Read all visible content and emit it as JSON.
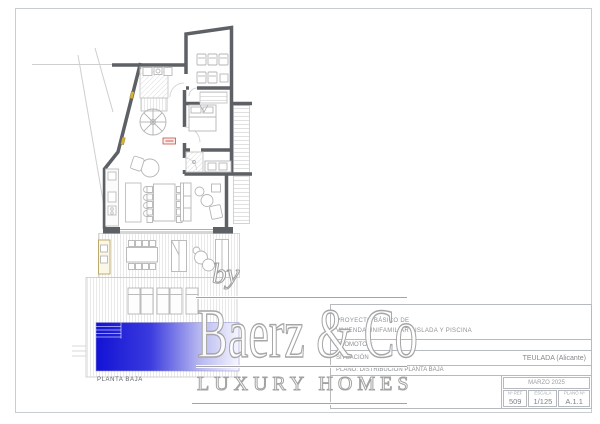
{
  "plan": {
    "floor_label": "PLANTA BAJA"
  },
  "watermark": {
    "by": "by",
    "brand": "Baerz & Co",
    "tagline": "LUXURY HOMES"
  },
  "title_block": {
    "project_line1": "PROYECTO BÁSICO DE",
    "project_line2": "VIVIENDA UNIFAMILIAR AISLADA Y PISCINA",
    "promoter_label": "PROMOTOR:",
    "location_label": "SITUACIÓN",
    "location_value": "TEULADA (Alicante)",
    "sheet_title": "PLANO: DISTRIBUCIÓN PLANTA BAJA",
    "date": "MARZO 2025",
    "ref_label": "Nº REF",
    "ref_value": "509",
    "scale_label": "ESCALA",
    "scale_value": "1/125",
    "sheet_no_label": "PLANO Nº",
    "sheet_no_value": "A.1.1"
  },
  "colors": {
    "wall": "#5d6064",
    "pool_blue": "#1212d4",
    "door_accent": "#d8b23c",
    "marker_red": "#c0392b"
  }
}
